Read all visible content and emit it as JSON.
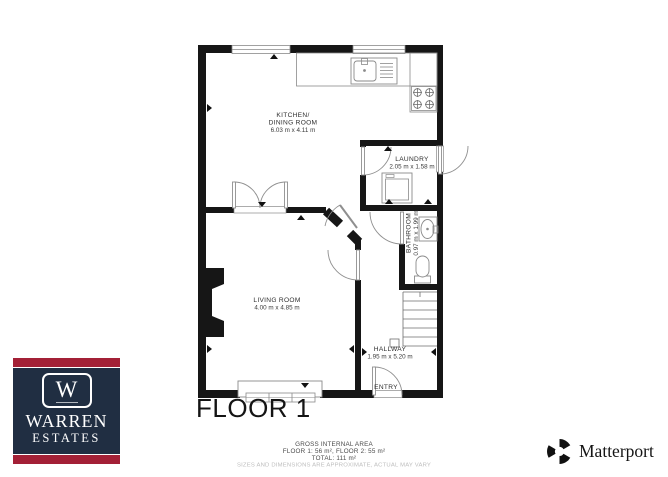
{
  "floor_plan": {
    "floor_label": "FLOOR 1",
    "rooms": {
      "kitchen": {
        "name_line1": "KITCHEN/",
        "name_line2": "DINING ROOM",
        "dimensions": "6.03 m x 4.11 m"
      },
      "laundry": {
        "name": "LAUNDRY",
        "dimensions": "2.05 m x 1.58 m"
      },
      "bathroom": {
        "name": "BATHROOM",
        "dimensions": "0.97 m x 1.99 m"
      },
      "living_room": {
        "name": "LIVING ROOM",
        "dimensions": "4.00 m x 4.85 m"
      },
      "hallway": {
        "name": "HALLWAY",
        "dimensions": "1.95 m x 5.20 m"
      },
      "entry": {
        "name": "ENTRY"
      }
    }
  },
  "footer": {
    "area_title": "GROSS INTERNAL AREA",
    "area_line": "FLOOR 1: 56 m², FLOOR 2: 55 m²",
    "total_line": "TOTAL: 111 m²",
    "disclaimer": "SIZES AND DIMENSIONS ARE APPROXIMATE, ACTUAL MAY VARY"
  },
  "branding": {
    "agency": {
      "monogram": "W",
      "name_line1": "WARREN",
      "name_line2": "ESTATES",
      "navy": "#202e42",
      "red": "#a32036"
    },
    "provider": {
      "name": "Matterport"
    }
  }
}
